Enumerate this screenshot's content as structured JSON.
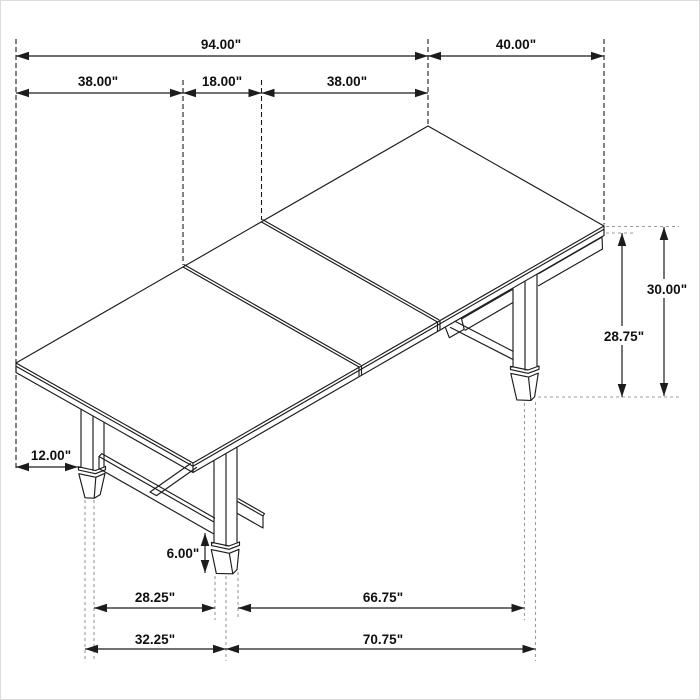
{
  "diagram": {
    "type": "furniture-dimension-drawing",
    "subject": "Extendable trestle dining table with center leaf, isometric line drawing",
    "units": "inches",
    "colors": {
      "ink": "#1c1c1c",
      "reference": "#9c9c9c",
      "background": "#ffffff"
    },
    "dims": {
      "overall_length": "94.00\"",
      "tabletop_width": "40.00\"",
      "end_section_left": "38.00\"",
      "center_leaf": "18.00\"",
      "end_section_right": "38.00\"",
      "table_height": "30.00\"",
      "underside_clearance": "28.75\"",
      "top_overhang": "12.00\"",
      "foot_height": "6.00\"",
      "foot_span_width_inner": "28.25\"",
      "foot_span_width_outer": "32.25\"",
      "foot_span_length_inner": "66.75\"",
      "foot_span_length_outer": "70.75\""
    }
  }
}
